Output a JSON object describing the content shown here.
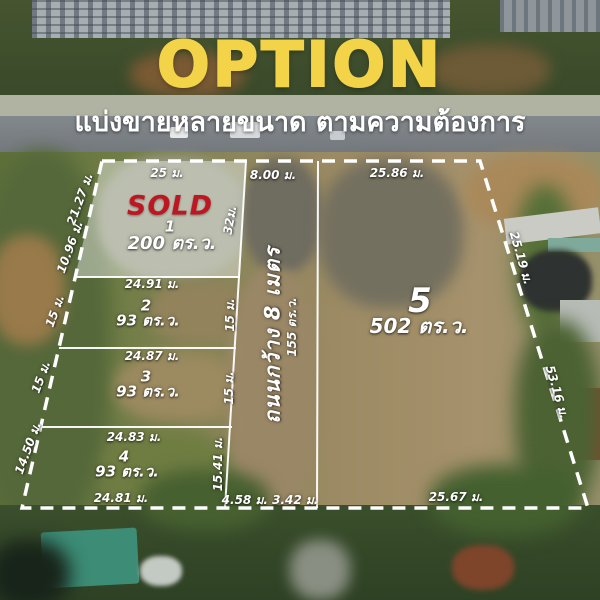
{
  "header": {
    "title": "OPTION",
    "subtitle": "แบ่งขายหลายขนาด ตามความต้องการ"
  },
  "colors": {
    "title_yellow": "#f3d449",
    "sold_red": "#bf1722",
    "boundary_white": "#ffffff"
  },
  "plots": {
    "p1": {
      "number": "1",
      "status": "SOLD",
      "area": "200 ตร.ว.",
      "dim_top": "25 ม.",
      "dim_left_upper": "21.27 ม.",
      "dim_left_lower": "10.96 ม.",
      "dim_right": "32ม."
    },
    "p2": {
      "number": "2",
      "area": "93 ตร.ว.",
      "dim_top": "24.91 ม.",
      "dim_left": "15 ม.",
      "dim_right": "15 ม."
    },
    "p3": {
      "number": "3",
      "area": "93 ตร.ว.",
      "dim_top": "24.87 ม.",
      "dim_left": "15 ม.",
      "dim_right": "15 ม."
    },
    "p4": {
      "number": "4",
      "area": "93 ตร.ว.",
      "dim_top": "24.83 ม.",
      "dim_left": "14.50 ม.",
      "dim_right": "15.41 ม.",
      "dim_bottom": "24.81 ม."
    },
    "p5": {
      "number": "5",
      "area": "502 ตร.ว.",
      "dim_top": "25.86 ม.",
      "dim_right_upper": "25.19 ม.",
      "dim_right_lower": "53.16 ม.",
      "dim_bottom": "25.67 ม."
    }
  },
  "road": {
    "name": "ถนนกว้าง 8 เมตร",
    "area": "155 ตร.ว.",
    "dim_top": "8.00 ม.",
    "dim_bottom": "4.58 ม. 3.42 ม."
  }
}
